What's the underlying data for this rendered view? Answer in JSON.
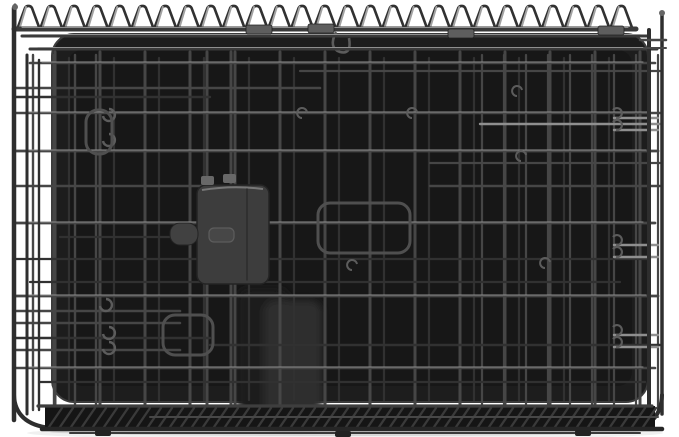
{
  "meta": {
    "description": "Product photo: a black folding metal wire dog crate shown collapsed flat, with a black plastic floor pan and a dark gray plastic door latch in the center, photographed on a plain white background with a soft shadow underneath."
  },
  "palette": {
    "background": "#ffffff",
    "pan": "#1d1d1d",
    "pan_inner": "#171717",
    "pan_edge": "#3c3c3c",
    "wire_dark": "#313131",
    "wire": "#464646",
    "wire_bright": "#8f8f8f",
    "loop_bright": "#a2a2a2",
    "rail": "#3a3a3a",
    "frame": "#2e2e2e",
    "hook": "#5c5c5c",
    "handle": "#4f4f4f",
    "latch_body": "#3d3d3d",
    "latch_edge": "#242424",
    "latch_highlight": "#7d7d7d",
    "clamp": "#5e5e5e",
    "shadow": "#000000"
  },
  "scene": {
    "w": 679,
    "h": 437,
    "shadow": {
      "cx": 345,
      "cy": 433,
      "rx": 318,
      "ry": 7,
      "opacity": 0.06,
      "cx2": 345,
      "cy2": 432,
      "rx2": 295,
      "ry2": 4,
      "opacity2": 0.1
    },
    "pan": {
      "x": 52,
      "y": 34,
      "w": 596,
      "h": 368,
      "rx": 22
    },
    "blur": [
      [
        237,
        288,
        52,
        132,
        "#1a1a1a"
      ],
      [
        264,
        300,
        58,
        126,
        "#2f2f2f"
      ]
    ],
    "grids": {
      "main": {
        "x0": 55,
        "dx": 45,
        "n": 14,
        "y1": 52,
        "y2": 412,
        "w": 3
      },
      "back": {
        "x0": 69,
        "dx": 45,
        "n": 13,
        "y1": 58,
        "y2": 400,
        "w": 2.2
      },
      "right": {
        "x0": 482,
        "dx": 22,
        "n": 9,
        "y1": 55,
        "y2": 410,
        "w": 2.2
      },
      "left": {
        "x0": 33,
        "dx": 21,
        "n": 4,
        "y1": 55,
        "y2": 410,
        "w": 2.4
      },
      "latchWires": [
        207,
        231
      ]
    },
    "horizontals": [
      [
        63,
        30,
        655,
        2.6,
        1,
        1
      ],
      [
        71,
        300,
        660,
        2.2,
        1,
        0
      ],
      [
        88,
        16,
        320,
        2.6,
        1,
        0
      ],
      [
        97,
        16,
        210,
        2.4,
        0,
        0
      ],
      [
        113,
        16,
        660,
        2.5,
        1,
        1
      ],
      [
        124,
        480,
        660,
        2.4,
        2,
        0
      ],
      [
        151,
        16,
        658,
        2.8,
        1,
        1
      ],
      [
        163,
        430,
        660,
        2.2,
        1,
        0
      ],
      [
        186,
        16,
        250,
        2.5,
        1,
        0
      ],
      [
        186,
        430,
        660,
        2.4,
        1,
        0
      ],
      [
        223,
        16,
        655,
        2.7,
        1,
        1
      ],
      [
        237,
        60,
        210,
        2.2,
        0,
        0
      ],
      [
        259,
        16,
        650,
        2.3,
        0,
        0
      ],
      [
        282,
        30,
        620,
        2.2,
        0,
        0
      ],
      [
        296,
        16,
        658,
        2.8,
        1,
        1
      ],
      [
        311,
        16,
        180,
        2.6,
        1,
        0
      ],
      [
        323,
        16,
        180,
        2.5,
        1,
        0
      ],
      [
        338,
        16,
        210,
        2.4,
        0,
        0
      ],
      [
        345,
        210,
        660,
        2.4,
        0,
        0
      ],
      [
        350,
        16,
        180,
        2.6,
        1,
        0
      ],
      [
        368,
        16,
        655,
        2.6,
        1,
        1
      ],
      [
        382,
        40,
        645,
        2.2,
        0,
        0
      ]
    ],
    "hooksLeft": [
      [
        103,
        116
      ],
      [
        103,
        141
      ],
      [
        100,
        306
      ],
      [
        103,
        334
      ],
      [
        103,
        349
      ]
    ],
    "hooksMid": [
      [
        517,
        96
      ],
      [
        521,
        161
      ],
      [
        412,
        118
      ],
      [
        545,
        268
      ],
      [
        352,
        270
      ],
      [
        302,
        118
      ]
    ],
    "hooksRight": [
      118,
      130,
      245,
      257,
      335,
      347
    ],
    "handles": [
      [
        318,
        203,
        92,
        50
      ],
      [
        86,
        110,
        26,
        44
      ],
      [
        163,
        315,
        50,
        40
      ]
    ],
    "dring": [
      336,
      32
    ],
    "loops": {
      "n": 27,
      "x0": 26,
      "dx": 22.8,
      "yTop": 6,
      "yBase": 27
    },
    "rails": [
      [
        29,
        14,
        636,
        5
      ],
      [
        36,
        22,
        648,
        3
      ],
      [
        49,
        30,
        657,
        3
      ]
    ],
    "clamps": [
      [
        246,
        25
      ],
      [
        308,
        24
      ],
      [
        448,
        29
      ],
      [
        598,
        26
      ]
    ],
    "posts": {
      "left": [
        [
          14,
          8,
          420,
          4.5
        ],
        [
          27,
          55,
          414,
          3
        ],
        [
          39,
          60,
          410,
          2.4
        ],
        [
          15,
          5,
          30,
          3
        ]
      ],
      "right": [
        [
          649,
          30,
          422,
          4
        ],
        [
          662,
          13,
          414,
          3.5
        ]
      ]
    },
    "rightConnectors": [
      [
        640,
        40,
        666,
        2.5
      ],
      [
        644,
        48,
        666,
        2
      ]
    ],
    "latch": {
      "body": [
        197,
        185,
        72,
        99
      ],
      "tab": [
        170,
        223,
        28,
        22
      ],
      "emboss": [
        209,
        228,
        25,
        14
      ],
      "wiresTop": [
        [
          201,
          176
        ],
        [
          223,
          174
        ]
      ]
    },
    "hatch": {
      "x1": 45,
      "x2": 655,
      "yTop": 406,
      "yBot": 429,
      "step": 11
    },
    "botRails": [
      [
        406,
        38,
        652,
        3.2,
        "#3e3e3e"
      ],
      [
        417,
        150,
        658,
        2,
        "#474747"
      ],
      [
        429,
        42,
        662,
        4.5,
        "#262626"
      ],
      [
        433,
        70,
        640,
        2,
        "#3a3a3a"
      ]
    ],
    "feet": [
      [
        95,
        430
      ],
      [
        335,
        431
      ],
      [
        575,
        430
      ]
    ],
    "curves": [
      "M14 395 Q15 424 50 428",
      "M662 395 Q661 424 634 428"
    ]
  }
}
